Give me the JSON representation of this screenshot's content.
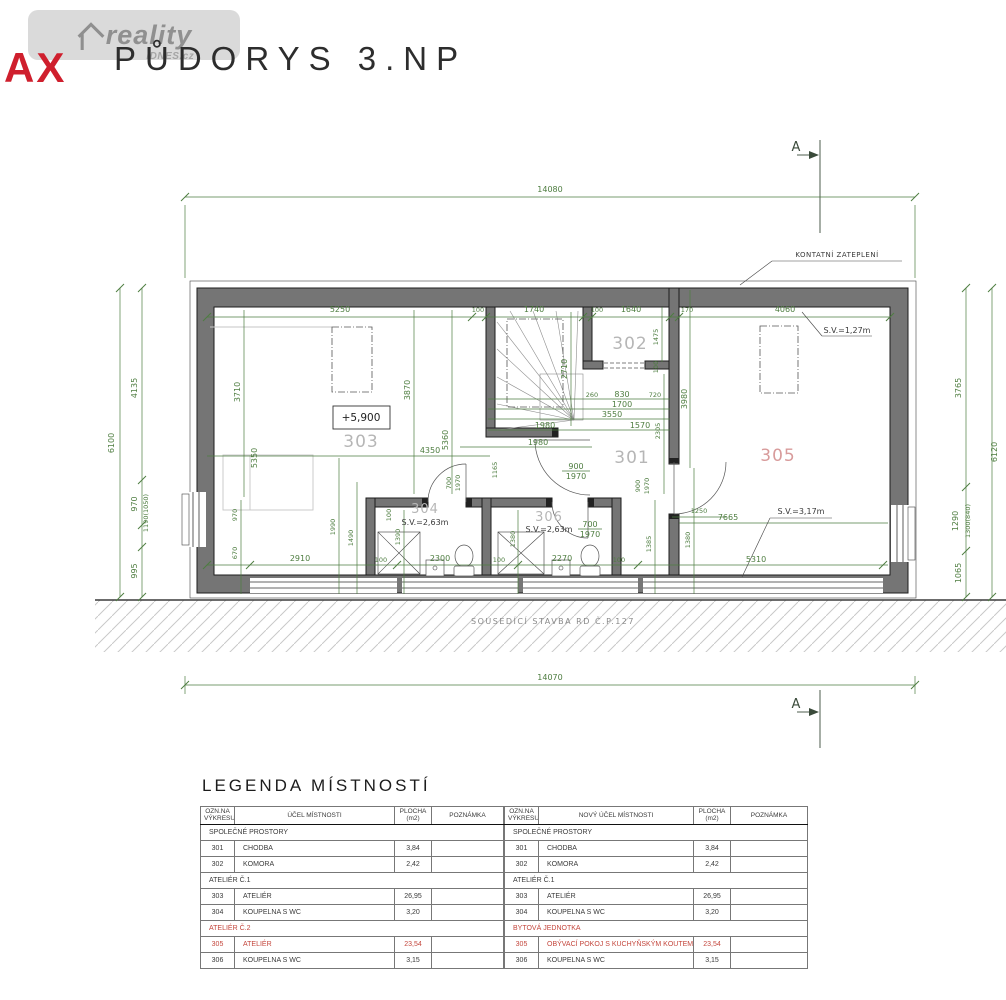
{
  "header": {
    "logo_text": "reality",
    "logo_sub": "iDNES.cz",
    "brand_fragment": "AX",
    "title": "PŮDORYS 3.NP"
  },
  "colors": {
    "dimension_green": "#4e7d40",
    "wall_gray": "#757575",
    "highlight_red": "#c4473d",
    "room_label_gray": "#b6b6b6"
  },
  "plan": {
    "section_label": "A",
    "notes": {
      "insulation": "KONTATNÍ ZATEPLENÍ",
      "neighbor": "SOUSEDÍCÍ STAVBA RD Č.P.127"
    },
    "level": "+5,900",
    "rooms": {
      "r301": "301",
      "r302": "302",
      "r303": "303",
      "r304": "304",
      "r305": "305",
      "r306": "306"
    },
    "sv": {
      "room304": "S.V.=2,63m",
      "room306": "S.V.=2,63m",
      "room305_top": "S.V.=1,27m",
      "room305_bottom": "S.V.=3,17m"
    },
    "dims": {
      "top_total": "14080",
      "bottom_total": "14070",
      "left_total": "6100",
      "l1": "4135",
      "l2": "970",
      "l3": "1190(1050)",
      "l4": "995",
      "right_total": "6120",
      "r1": "3765",
      "r2": "1290",
      "r3": "1300(840)",
      "r4": "1065",
      "t1": "5250",
      "t2": "100",
      "t3": "1740",
      "t4": "100",
      "t5": "1640",
      "t6": "170",
      "t7": "4060",
      "v303a": "3710",
      "v303b": "5350",
      "v303c": "3870",
      "v303d": "5360",
      "v_stair": "2710",
      "v302": "1475",
      "w100": "100",
      "v305l": "3980",
      "v301": "2305",
      "v1165": "1165",
      "s1": "260",
      "s2": "830",
      "s3": "720",
      "s4": "1700",
      "s5": "3550",
      "s6": "1980",
      "s7": "1570",
      "s8": "1980",
      "h4350": "4350",
      "d1250": "1250",
      "h7665": "7665",
      "door700w": "700",
      "door700h": "1970",
      "door900w": "900",
      "door900h": "1970",
      "v1390": "1390",
      "v1380": "1380",
      "v1385": "1385",
      "b1": "2910",
      "b2": "2300",
      "b3": "2270",
      "b4": "5310",
      "v970": "970",
      "v670": "670",
      "v1990": "1990",
      "v1490": "1490"
    }
  },
  "legend": {
    "title": "LEGENDA MÍSTNOSTÍ",
    "left": {
      "headers": {
        "col1a": "OZN.NA",
        "col1b": "VÝKRESU",
        "col2": "ÚČEL MÍSTNOSTI",
        "col3a": "PLOCHA",
        "col3b": "(m2)",
        "col4": "POZNÁMKA"
      },
      "rows": [
        {
          "section": "SPOLEČNÉ PROSTORY"
        },
        {
          "id": "301",
          "name": "CHODBA",
          "area": "3,84",
          "note": ""
        },
        {
          "id": "302",
          "name": "KOMORA",
          "area": "2,42",
          "note": ""
        },
        {
          "section": "ATELIÉR Č.1"
        },
        {
          "id": "303",
          "name": "ATELIÉR",
          "area": "26,95",
          "note": ""
        },
        {
          "id": "304",
          "name": "KOUPELNA S WC",
          "area": "3,20",
          "note": ""
        },
        {
          "section": "ATELIÉR Č.2"
        },
        {
          "id": "305",
          "name": "ATELIÉR",
          "area": "23,54",
          "note": ""
        },
        {
          "id": "306",
          "name": "KOUPELNA S WC",
          "area": "3,15",
          "note": ""
        }
      ]
    },
    "right": {
      "headers": {
        "col1a": "OZN.NA",
        "col1b": "VÝKRESU",
        "col2": "NOVÝ ÚČEL MÍSTNOSTI",
        "col3a": "PLOCHA",
        "col3b": "(m2)",
        "col4": "POZNÁMKA"
      },
      "rows": [
        {
          "section": "SPOLEČNÉ PROSTORY"
        },
        {
          "id": "301",
          "name": "CHODBA",
          "area": "3,84",
          "note": ""
        },
        {
          "id": "302",
          "name": "KOMORA",
          "area": "2,42",
          "note": ""
        },
        {
          "section": "ATELIÉR Č.1"
        },
        {
          "id": "303",
          "name": "ATELIÉR",
          "area": "26,95",
          "note": ""
        },
        {
          "id": "304",
          "name": "KOUPELNA S WC",
          "area": "3,20",
          "note": ""
        },
        {
          "section": "BYTOVÁ JEDNOTKA"
        },
        {
          "id": "305",
          "name": "OBÝVACÍ POKOJ S KUCHYŇSKÝM KOUTEM",
          "area": "23,54",
          "note": ""
        },
        {
          "id": "306",
          "name": "KOUPELNA S WC",
          "area": "3,15",
          "note": ""
        }
      ]
    }
  }
}
